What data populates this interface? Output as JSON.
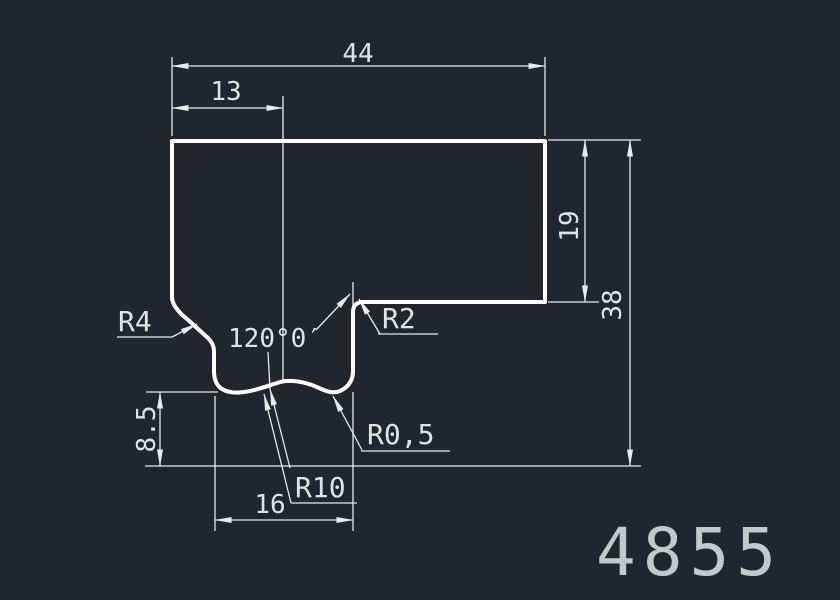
{
  "drawing": {
    "part_number": "4855",
    "dims": {
      "total_width": "44",
      "left_width": "13",
      "right_height": "19",
      "total_height": "38",
      "notch_depth": "8.5",
      "notch_width": "16",
      "angle": "120°0′",
      "fillet_top_left": "R4",
      "fillet_top_right": "R2",
      "fillet_bottom_small": "R0,5",
      "groove_radius": "R10"
    }
  },
  "colors": {
    "background": "#21262e",
    "dim_line": "#e7eaed",
    "profile_line": "#ffffff",
    "dim_text": "#dfe3e6",
    "part_number_text": "#c3c8cd"
  }
}
